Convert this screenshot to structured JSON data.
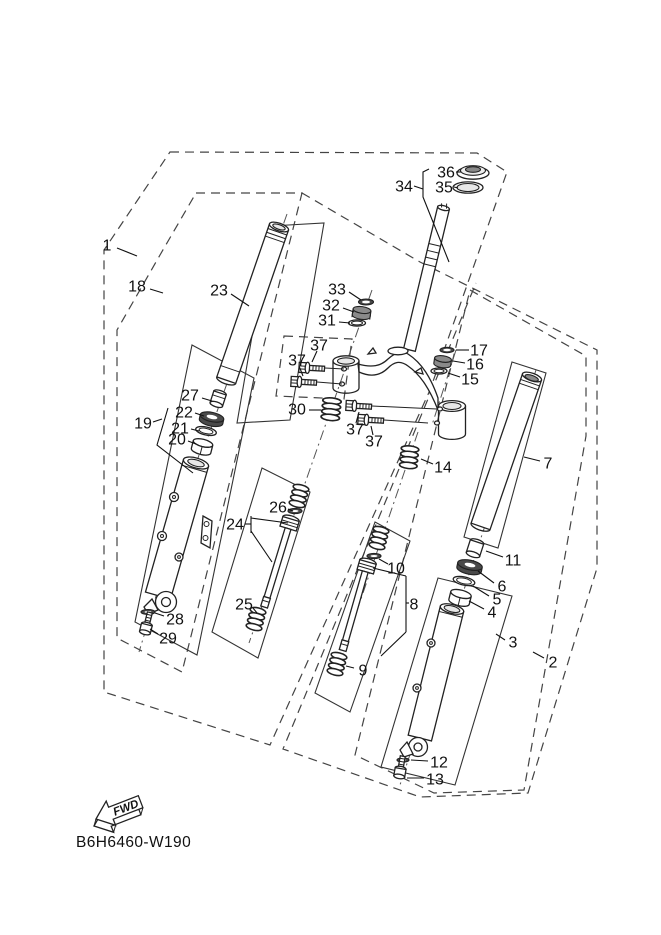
{
  "diagram": {
    "code": "B6H6460-W190",
    "fwd": "FWD",
    "colors": {
      "line": "#1a1a1a",
      "background": "#ffffff",
      "boundary": "#444444",
      "seal_dark": "#4a4a4a"
    },
    "callouts": [
      {
        "label": "1",
        "x": 107,
        "y": 245,
        "leader": [
          [
            117,
            248
          ],
          [
            137,
            256
          ]
        ]
      },
      {
        "label": "18",
        "x": 137,
        "y": 286,
        "leader": [
          [
            150,
            289
          ],
          [
            163,
            293
          ]
        ]
      },
      {
        "label": "23",
        "x": 219,
        "y": 290,
        "leader": [
          [
            231,
            294
          ],
          [
            249,
            306
          ]
        ]
      },
      {
        "label": "33",
        "x": 337,
        "y": 289,
        "leader": [
          [
            349,
            292
          ],
          [
            361,
            300
          ]
        ]
      },
      {
        "label": "32",
        "x": 331,
        "y": 305,
        "leader": [
          [
            343,
            308
          ],
          [
            354,
            312
          ]
        ]
      },
      {
        "label": "31",
        "x": 327,
        "y": 320,
        "leader": [
          [
            339,
            322
          ],
          [
            350,
            323
          ]
        ]
      },
      {
        "label": "36",
        "x": 446,
        "y": 172,
        "leader": [
          [
            456,
            172
          ],
          [
            461,
            172
          ]
        ]
      },
      {
        "label": "35",
        "x": 444,
        "y": 187,
        "leader": [
          [
            454,
            187
          ],
          [
            458,
            188
          ]
        ]
      },
      {
        "label": "34",
        "x": 404,
        "y": 186,
        "leader": [
          [
            414,
            186
          ],
          [
            423,
            189
          ]
        ]
      },
      {
        "label": "37",
        "x": 319,
        "y": 345,
        "leader": [
          [
            317,
            351
          ],
          [
            312,
            362
          ]
        ]
      },
      {
        "label": "37",
        "x": 297,
        "y": 360,
        "leader": [
          [
            299,
            366
          ],
          [
            303,
            376
          ]
        ]
      },
      {
        "label": "37",
        "x": 355,
        "y": 429,
        "leader": [
          [
            356,
            423
          ],
          [
            359,
            412
          ]
        ]
      },
      {
        "label": "37",
        "x": 374,
        "y": 441,
        "leader": [
          [
            373,
            435
          ],
          [
            371,
            426
          ]
        ]
      },
      {
        "label": "30",
        "x": 297,
        "y": 409,
        "leader": [
          [
            309,
            410
          ],
          [
            321,
            410
          ]
        ]
      },
      {
        "label": "14",
        "x": 443,
        "y": 467,
        "leader": [
          [
            433,
            464
          ],
          [
            421,
            459
          ]
        ]
      },
      {
        "label": "17",
        "x": 479,
        "y": 350,
        "leader": [
          [
            469,
            350
          ],
          [
            456,
            350
          ]
        ]
      },
      {
        "label": "16",
        "x": 475,
        "y": 364,
        "leader": [
          [
            465,
            363
          ],
          [
            453,
            361
          ]
        ]
      },
      {
        "label": "15",
        "x": 470,
        "y": 379,
        "leader": [
          [
            460,
            377
          ],
          [
            448,
            373
          ]
        ]
      },
      {
        "label": "7",
        "x": 548,
        "y": 463,
        "leader": [
          [
            540,
            461
          ],
          [
            524,
            457
          ]
        ]
      },
      {
        "label": "11",
        "x": 513,
        "y": 560,
        "leader": [
          [
            503,
            557
          ],
          [
            486,
            551
          ]
        ]
      },
      {
        "label": "6",
        "x": 502,
        "y": 586,
        "leader": [
          [
            494,
            583
          ],
          [
            478,
            571
          ]
        ]
      },
      {
        "label": "5",
        "x": 497,
        "y": 599,
        "leader": [
          [
            489,
            596
          ],
          [
            473,
            586
          ]
        ]
      },
      {
        "label": "4",
        "x": 492,
        "y": 612,
        "leader": [
          [
            484,
            609
          ],
          [
            469,
            601
          ]
        ]
      },
      {
        "label": "3",
        "x": 513,
        "y": 642,
        "leader": [
          [
            505,
            640
          ],
          [
            496,
            634
          ]
        ]
      },
      {
        "label": "2",
        "x": 553,
        "y": 662,
        "leader": [
          [
            544,
            658
          ],
          [
            533,
            652
          ]
        ]
      },
      {
        "label": "27",
        "x": 190,
        "y": 395,
        "leader": [
          [
            202,
            398
          ],
          [
            212,
            401
          ]
        ]
      },
      {
        "label": "19",
        "x": 143,
        "y": 423,
        "leader": [
          [
            153,
            422
          ],
          [
            162,
            419
          ]
        ]
      },
      {
        "label": "22",
        "x": 184,
        "y": 412,
        "leader": [
          [
            195,
            413
          ],
          [
            204,
            416
          ]
        ]
      },
      {
        "label": "21",
        "x": 180,
        "y": 428,
        "leader": [
          [
            191,
            429
          ],
          [
            199,
            431
          ]
        ]
      },
      {
        "label": "20",
        "x": 177,
        "y": 439,
        "leader": [
          [
            188,
            441
          ],
          [
            196,
            444
          ]
        ]
      },
      {
        "label": "24",
        "x": 235,
        "y": 524,
        "leader": [
          [
            245,
            524
          ],
          [
            251,
            524
          ]
        ]
      },
      {
        "label": "26",
        "x": 278,
        "y": 507,
        "leader": [
          [
            288,
            509
          ],
          [
            293,
            511
          ]
        ]
      },
      {
        "label": "25",
        "x": 244,
        "y": 604,
        "leader": [
          [
            253,
            608
          ],
          [
            257,
            613
          ]
        ]
      },
      {
        "label": "28",
        "x": 175,
        "y": 619,
        "leader": [
          [
            164,
            616
          ],
          [
            155,
            613
          ]
        ]
      },
      {
        "label": "29",
        "x": 168,
        "y": 638,
        "leader": [
          [
            158,
            634
          ],
          [
            150,
            629
          ]
        ]
      },
      {
        "label": "8",
        "x": 414,
        "y": 604,
        "leader": [
          [
            409,
            603
          ],
          [
            406,
            603
          ]
        ]
      },
      {
        "label": "9",
        "x": 363,
        "y": 670,
        "leader": [
          [
            354,
            668
          ],
          [
            346,
            666
          ]
        ]
      },
      {
        "label": "10",
        "x": 396,
        "y": 568,
        "leader": [
          [
            388,
            564
          ],
          [
            379,
            559
          ]
        ]
      },
      {
        "label": "12",
        "x": 439,
        "y": 762,
        "leader": [
          [
            428,
            761
          ],
          [
            411,
            760
          ]
        ]
      },
      {
        "label": "13",
        "x": 435,
        "y": 779,
        "leader": [
          [
            424,
            778
          ],
          [
            407,
            778
          ]
        ]
      }
    ]
  }
}
